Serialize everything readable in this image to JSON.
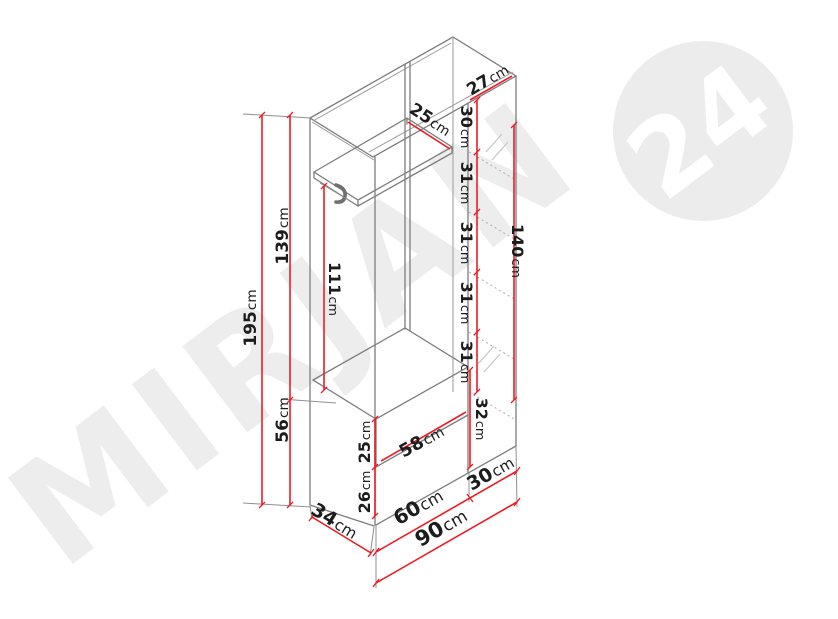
{
  "diagram": {
    "type": "furniture-dimension-drawing",
    "subject": "hallway wardrobe unit with hat shelf, coat hook, shoe bench and shelf column"
  },
  "watermark": {
    "brand": "MIRJAN",
    "badge": "24"
  },
  "colors": {
    "dimension_line": "#ed1c24",
    "structure_line": "#7d7d7d",
    "watermark": "#ededed",
    "background": "#ffffff"
  },
  "dims": {
    "total_height": {
      "v": "195",
      "u": "cm"
    },
    "upper_section_height": {
      "v": "139",
      "u": "cm"
    },
    "bench_height": {
      "v": "56",
      "u": "cm"
    },
    "hanging_height": {
      "v": "111",
      "u": "cm"
    },
    "hat_shelf_depth": {
      "v": "25",
      "u": "cm"
    },
    "top_panel_depth": {
      "v": "27",
      "u": "cm"
    },
    "column_top_compartment": {
      "v": "30",
      "u": "cm"
    },
    "column_gap_1": {
      "v": "31",
      "u": "cm"
    },
    "column_gap_2": {
      "v": "31",
      "u": "cm"
    },
    "column_gap_3": {
      "v": "31",
      "u": "cm"
    },
    "column_gap_4": {
      "v": "31",
      "u": "cm"
    },
    "column_glass_height": {
      "v": "140",
      "u": "cm"
    },
    "column_bottom_compartment": {
      "v": "32",
      "u": "cm"
    },
    "drawer_front_upper": {
      "v": "25",
      "u": "cm"
    },
    "drawer_front_lower": {
      "v": "26",
      "u": "cm"
    },
    "bench_inner_width": {
      "v": "58",
      "u": "cm"
    },
    "cabinet_depth": {
      "v": "34",
      "u": "cm"
    },
    "left_section_width": {
      "v": "60",
      "u": "cm"
    },
    "right_section_width": {
      "v": "30",
      "u": "cm"
    },
    "total_width": {
      "v": "90",
      "u": "cm"
    }
  }
}
